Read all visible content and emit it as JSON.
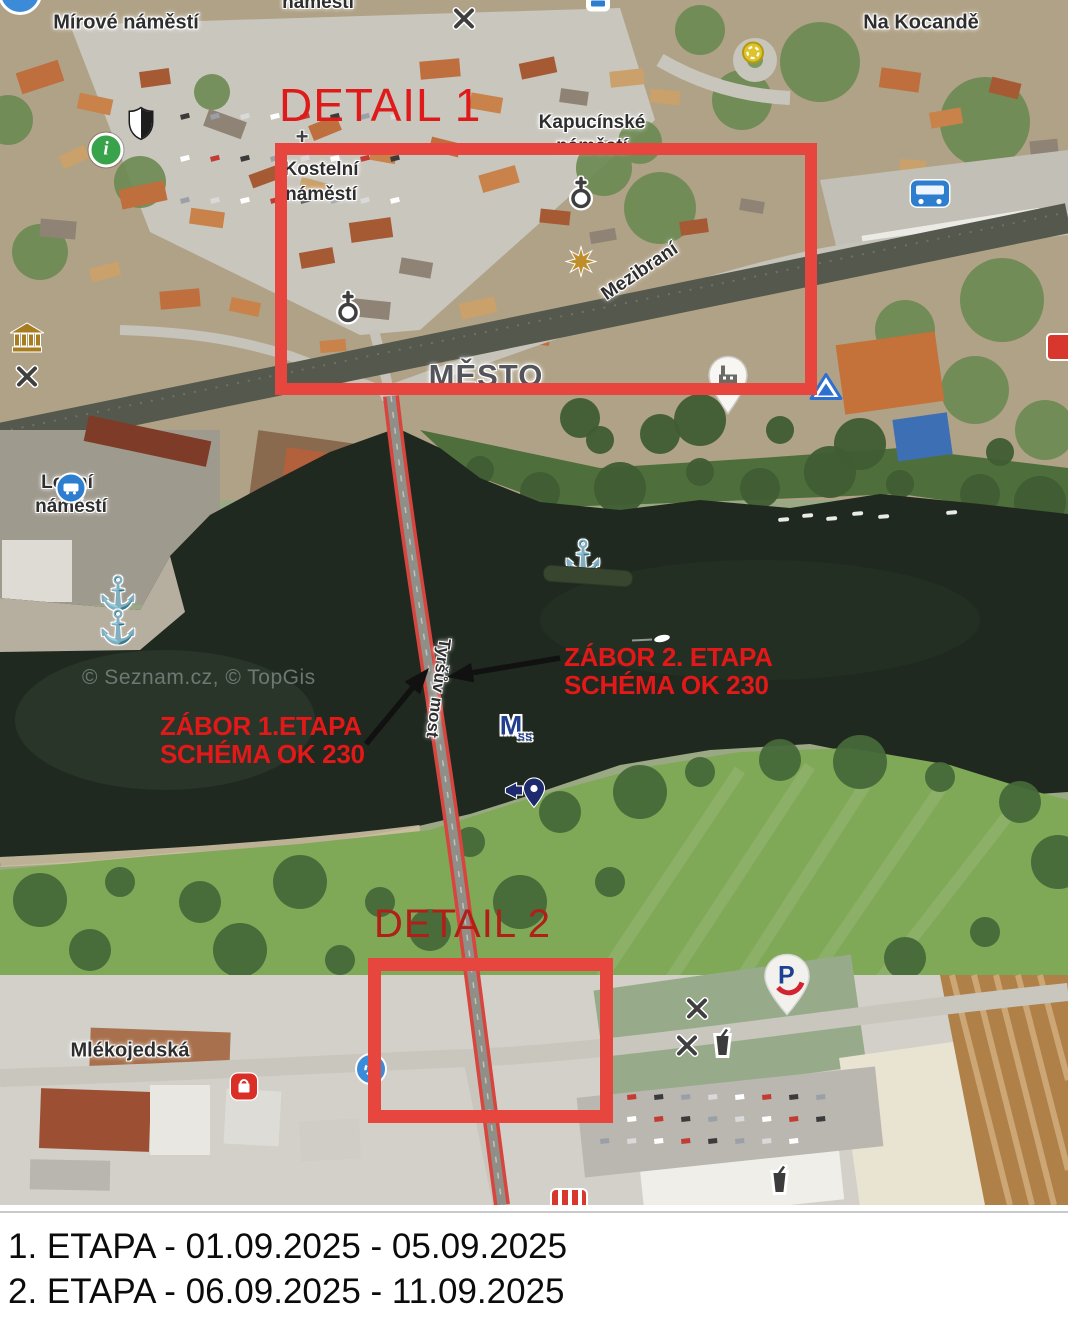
{
  "colors": {
    "annotation_red": "#e31818",
    "detail1_text_red": "#df1a1a",
    "detail2_text_red": "#b02018",
    "rectangle_red": "#e7463e",
    "bridge_highlight_red": "#d8453e",
    "arrow_black": "#111111",
    "water_dark": "#20291f",
    "label_text": "#2e2e2e"
  },
  "map": {
    "watermark": {
      "text": "© Seznam.cz, © TopGis",
      "x": 82,
      "y": 666
    },
    "labels": [
      {
        "id": "namesti-top",
        "text": "náměstí",
        "x": 318,
        "y": 3,
        "size": 19,
        "rotate": 0,
        "kind": "place"
      },
      {
        "id": "mirove-namesti",
        "text": "Mírové náměstí",
        "x": 126,
        "y": 23,
        "size": 20,
        "rotate": 0,
        "kind": "place"
      },
      {
        "id": "na-kocande",
        "text": "Na Kocandě",
        "x": 921,
        "y": 23,
        "size": 20,
        "rotate": 0,
        "kind": "place"
      },
      {
        "id": "kapucinske-1",
        "text": "Kapucínské",
        "x": 592,
        "y": 123,
        "size": 19,
        "rotate": 0,
        "kind": "place"
      },
      {
        "id": "kapucinske-2",
        "text": "náměstí",
        "x": 592,
        "y": 147,
        "size": 19,
        "rotate": 0,
        "kind": "place"
      },
      {
        "id": "kostelni-1",
        "text": "Kostelní",
        "x": 321,
        "y": 170,
        "size": 19,
        "rotate": 0,
        "kind": "place"
      },
      {
        "id": "kostelni-2",
        "text": "náměstí",
        "x": 321,
        "y": 195,
        "size": 19,
        "rotate": 0,
        "kind": "place"
      },
      {
        "id": "mezibrani",
        "text": "Mezibraní",
        "x": 640,
        "y": 272,
        "size": 19,
        "rotate": -34,
        "kind": "street"
      },
      {
        "id": "mesto",
        "text": "MĚSTO",
        "x": 486,
        "y": 376,
        "size": 31,
        "rotate": 0,
        "kind": "district"
      },
      {
        "id": "lodni-1",
        "text": "Lodní",
        "x": 67,
        "y": 483,
        "size": 19,
        "rotate": 0,
        "kind": "place"
      },
      {
        "id": "lodni-2",
        "text": "náměstí",
        "x": 71,
        "y": 507,
        "size": 19,
        "rotate": 0,
        "kind": "place"
      },
      {
        "id": "tyrsuv-most",
        "text": "Tyršův most",
        "x": 438,
        "y": 688,
        "size": 17,
        "rotate": 97.5,
        "kind": "street"
      },
      {
        "id": "mlekojedska",
        "text": "Mlékojedská",
        "x": 130,
        "y": 1051,
        "size": 20,
        "rotate": 0,
        "kind": "street"
      }
    ],
    "icons": [
      {
        "type": "partial-circle-blue-icon",
        "x": 20,
        "y": -7
      },
      {
        "type": "restaurant-icon",
        "x": 464,
        "y": 21
      },
      {
        "type": "tram-partial-icon",
        "x": 598,
        "y": 5
      },
      {
        "type": "roundabout-icon",
        "x": 753,
        "y": 55
      },
      {
        "type": "bus-station-icon",
        "x": 930,
        "y": 197
      },
      {
        "type": "shield-icon",
        "x": 141,
        "y": 126
      },
      {
        "type": "info-icon",
        "x": 106,
        "y": 150
      },
      {
        "type": "cross-icon",
        "x": 302,
        "y": 137
      },
      {
        "type": "church-icon",
        "x": 581,
        "y": 196
      },
      {
        "type": "star-icon",
        "x": 581,
        "y": 264
      },
      {
        "type": "church-icon",
        "x": 348,
        "y": 310
      },
      {
        "type": "museum-icon",
        "x": 27,
        "y": 340
      },
      {
        "type": "restaurant-icon",
        "x": 27,
        "y": 379
      },
      {
        "type": "factory-pin-icon",
        "x": 728,
        "y": 388
      },
      {
        "type": "camp-icon",
        "x": 826,
        "y": 389
      },
      {
        "type": "partial-red-icon",
        "x": 1062,
        "y": 347
      },
      {
        "type": "bus-stop-icon",
        "x": 71,
        "y": 488
      },
      {
        "type": "anchor-icon",
        "x": 118,
        "y": 593
      },
      {
        "type": "anchor-icon",
        "x": 118,
        "y": 627
      },
      {
        "type": "anchor-icon",
        "x": 583,
        "y": 557
      },
      {
        "type": "barge-icon",
        "x": 588,
        "y": 576
      },
      {
        "type": "boat-icon",
        "x": 652,
        "y": 641
      },
      {
        "type": "m-marker-icon",
        "x": 511,
        "y": 726
      },
      {
        "type": "nav-pin-icon",
        "x": 526,
        "y": 796
      },
      {
        "type": "roundabout-partial-icon",
        "x": 371,
        "y": 1069
      },
      {
        "type": "shop-icon",
        "x": 244,
        "y": 1089
      },
      {
        "type": "penny-pin-icon",
        "x": 787,
        "y": 988
      },
      {
        "type": "restaurant-icon",
        "x": 697,
        "y": 1011
      },
      {
        "type": "restaurant-icon",
        "x": 687,
        "y": 1048
      },
      {
        "type": "drink-icon",
        "x": 722,
        "y": 1046
      },
      {
        "type": "drink-icon",
        "x": 779,
        "y": 1183
      },
      {
        "type": "kfc-partial-icon",
        "x": 569,
        "y": 1197
      }
    ],
    "boats_row": [
      [
        778,
        518
      ],
      [
        802,
        514
      ],
      [
        826,
        517
      ],
      [
        852,
        512
      ],
      [
        878,
        515
      ],
      [
        946,
        511
      ]
    ]
  },
  "annotations": {
    "detail1": {
      "label": "DETAIL 1",
      "text_x": 279,
      "text_y": 78,
      "font": 46,
      "rect": {
        "x": 275,
        "y": 143,
        "w": 542,
        "h": 252,
        "stroke": 12
      }
    },
    "detail2": {
      "label": "DETAIL 2",
      "text_x": 374,
      "text_y": 902,
      "font": 40,
      "rect": {
        "x": 368,
        "y": 958,
        "w": 245,
        "h": 165,
        "stroke": 13
      }
    },
    "zabor1": {
      "line1": "ZÁBOR 1.ETAPA",
      "line2": "SCHÉMA OK 230",
      "x": 160,
      "y": 712
    },
    "zabor2": {
      "line1": "ZÁBOR 2. ETAPA",
      "line2": "SCHÉMA OK 230",
      "x": 564,
      "y": 643
    },
    "arrows": [
      {
        "x1": 560,
        "y1": 658,
        "x2": 447,
        "y2": 677
      },
      {
        "x1": 366,
        "y1": 744,
        "x2": 429,
        "y2": 668
      }
    ]
  },
  "legend": {
    "line1": "1. ETAPA - 01.09.2025 - 05.09.2025",
    "line2": "2. ETAPA - 06.09.2025 - 11.09.2025"
  }
}
